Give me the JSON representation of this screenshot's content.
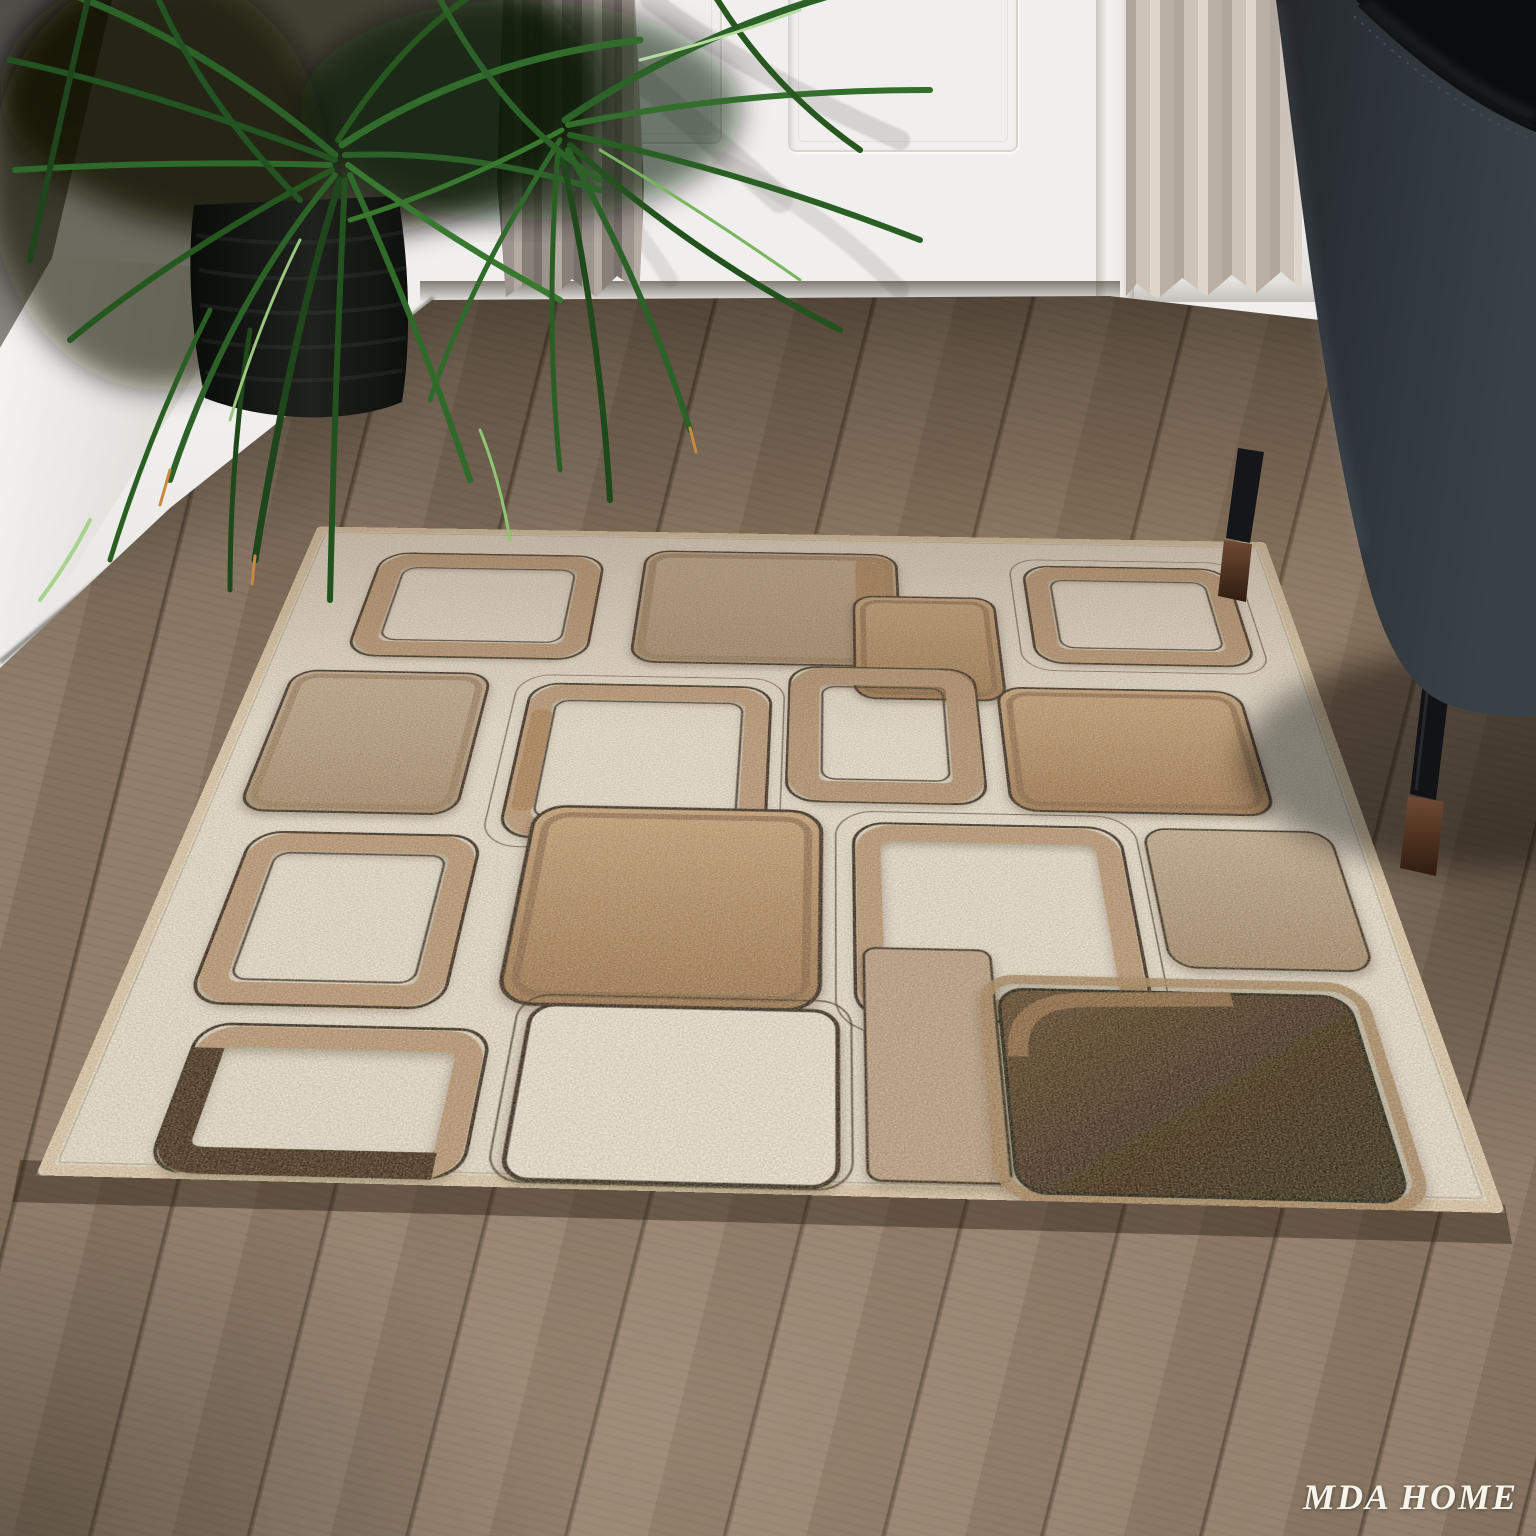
{
  "watermark": {
    "text": "MDA HOME"
  },
  "palette": {
    "rug_cream": "#e8e0d0",
    "rug_tan": "#b39776",
    "rug_caramel": "#a87c50",
    "rug_chocolate": "#2e1d0c",
    "rug_outline": "#241708",
    "rug_binding": "#dcc9a9",
    "floor_light": "#8d7a66",
    "floor_dark": "#3e3021",
    "wall_white": "#f0efed",
    "wall_gray": "#8e8c88",
    "curtain_left": "#9a918a",
    "curtain_right": "#cdc3b9",
    "leaf_green": "#2f6a2b",
    "pot_black": "#101210",
    "chair_leather": "#2d3338",
    "chair_leg_wood": "#5a3d2a"
  },
  "scene": {
    "objects": [
      "geometric-area-rug",
      "wood-plank-floor",
      "potted-palm-plant",
      "white-paneled-door",
      "left-curtain",
      "right-curtain",
      "black-leather-chair"
    ]
  }
}
